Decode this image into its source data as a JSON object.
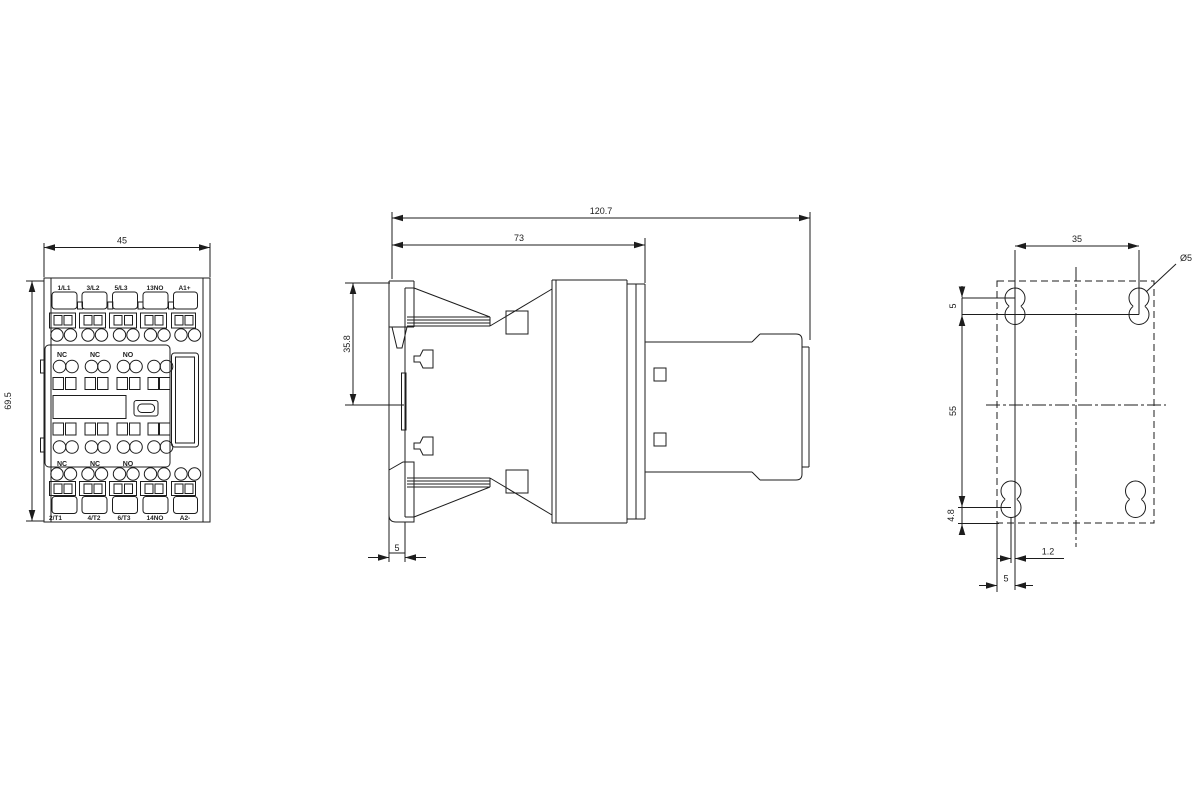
{
  "front_view": {
    "width_mm": "45",
    "height_mm": "69.5",
    "top_terminals": [
      "1/L1",
      "3/L2",
      "5/L3",
      "13NO",
      "A1+"
    ],
    "bottom_terminals": [
      "2/T1",
      "4/T2",
      "6/T3",
      "14NO",
      "A2-"
    ],
    "aux_contacts_top": [
      "NC",
      "NC",
      "NO"
    ],
    "aux_contacts_bottom": [
      "NC",
      "NC",
      "NO"
    ]
  },
  "side_view": {
    "total_depth_mm": "120.7",
    "body_depth_mm": "73",
    "din_clip_height_mm": "35.8",
    "rail_plate_depth_mm": "5"
  },
  "drilling_plan": {
    "hole_spacing_horizontal_mm": "35",
    "hole_spacing_vertical_mm": "55",
    "keyhole_center_offset_mm": "5",
    "bottom_edge_offset_mm": "4.8",
    "slot_offset_mm": "1.2",
    "slot_width_mm": "5",
    "hole_diameter": "Ø5"
  },
  "colors": {
    "line": "#1d1d1d",
    "background": "#ffffff"
  }
}
